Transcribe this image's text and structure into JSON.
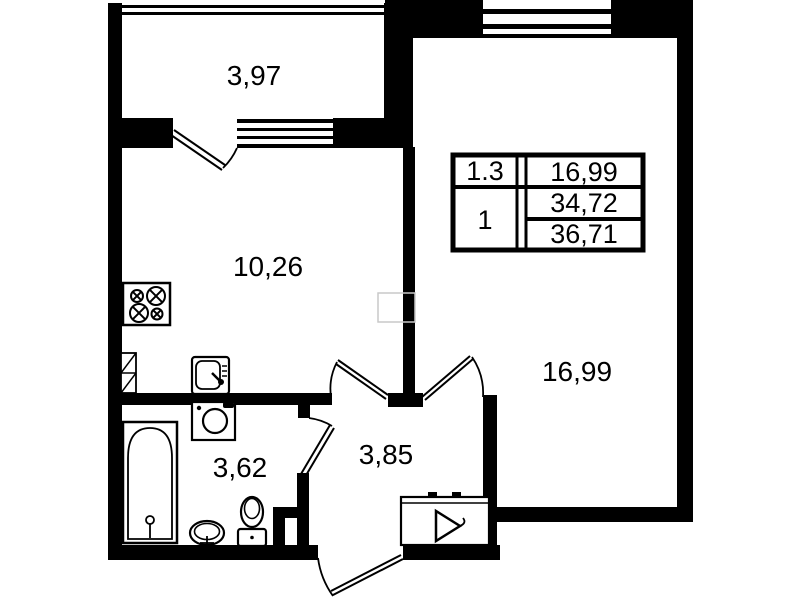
{
  "floor_plan": {
    "rooms": {
      "balcony_area": "3,97",
      "kitchen_area": "10,26",
      "living_room_area": "16,99",
      "bathroom_area": "3,62",
      "hall_area": "3,85"
    },
    "info_table": {
      "row1_left": "1.3",
      "row1_right": "16,99",
      "row2_left": "1",
      "row2_right_top": "34,72",
      "row2_right_bottom": "36,71"
    },
    "fixtures": [
      "stove",
      "kitchen-sink",
      "washing-machine",
      "bathtub",
      "washbasin",
      "toilet",
      "ventilation-shaft",
      "entrance-panel"
    ],
    "colors": {
      "walls": "#000000",
      "background": "#ffffff"
    }
  }
}
